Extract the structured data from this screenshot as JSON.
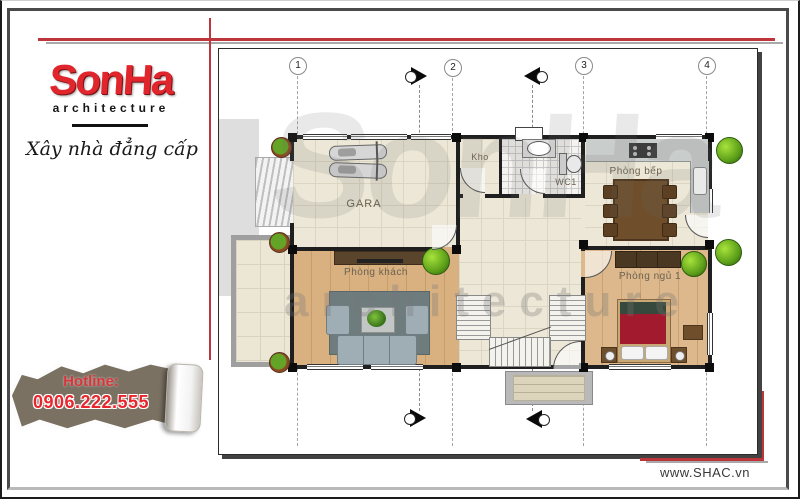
{
  "brand": {
    "logo_text": "SonHa",
    "logo_sub": "architecture",
    "tagline": "Xây nhà đẳng cấp",
    "hotline_label": "Hotline:",
    "hotline_number": "0906.222.555",
    "website": "www.SHAC.vn"
  },
  "watermark": {
    "logo": "SonHa",
    "sub": "architecture"
  },
  "plan": {
    "grid": {
      "g1": "1",
      "g2": "2",
      "g3": "3",
      "g4": "4"
    },
    "rooms": {
      "gara": "GARA",
      "kho": "Kho",
      "wc": "WC1",
      "bep": "Phòng bếp",
      "khach": "Phòng khách",
      "ngu": "Phòng ngủ 1"
    }
  },
  "colors": {
    "brand_red": "#e0262c",
    "line_red": "#bc363c",
    "paper_brown": "#7b7162",
    "floor_cream": "#ece7d6",
    "floor_wood": "#d9b181",
    "rug_gray": "#6f7c7e",
    "bed_red": "#a11a2d",
    "tree_green": "#5da019"
  }
}
